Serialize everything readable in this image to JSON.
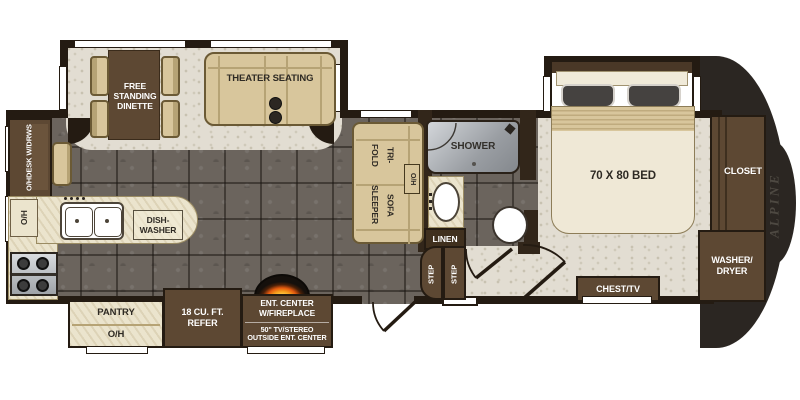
{
  "floorplan": {
    "brand": "ALPINE",
    "labels": {
      "desk": [
        "O/H",
        "DESK W/DRWS"
      ],
      "dinette": [
        "FREE",
        "STANDING",
        "DINETTE"
      ],
      "theater": "THEATER SEATING",
      "sofa": [
        "TRI-FOLD",
        "SOFA SLEEPER"
      ],
      "sofa_oh": "O/H",
      "kitchen_oh": "O/H",
      "dishwasher": [
        "DISH-",
        "WASHER"
      ],
      "shower": "SHOWER",
      "linen": "LINEN",
      "bed": "70 X 80 BED",
      "closet": "CLOSET",
      "washer_dryer": [
        "WASHER/",
        "DRYER"
      ],
      "chest_tv": "CHEST/TV",
      "steps": [
        "STEP",
        "STEP"
      ],
      "pantry": [
        "PANTRY",
        "O/H"
      ],
      "refer": [
        "18 CU. FT.",
        "REFER"
      ],
      "ent_center": [
        "ENT. CENTER",
        "W/FIREPLACE",
        "50\" TV/STEREO",
        "OUTSIDE ENT. CENTER"
      ]
    },
    "colors": {
      "wall": "#241b12",
      "floor_dark": "#6b645d",
      "floor_light": "#e2ddd2",
      "cabinet_brown": "#5d4833",
      "furniture_tan": "#d8c69c",
      "counter_cream": "#ebe4cd",
      "shower_silver": "#b9bcc0",
      "flame_orange": "#f59d1c",
      "front_cap": "#2b2622"
    }
  }
}
